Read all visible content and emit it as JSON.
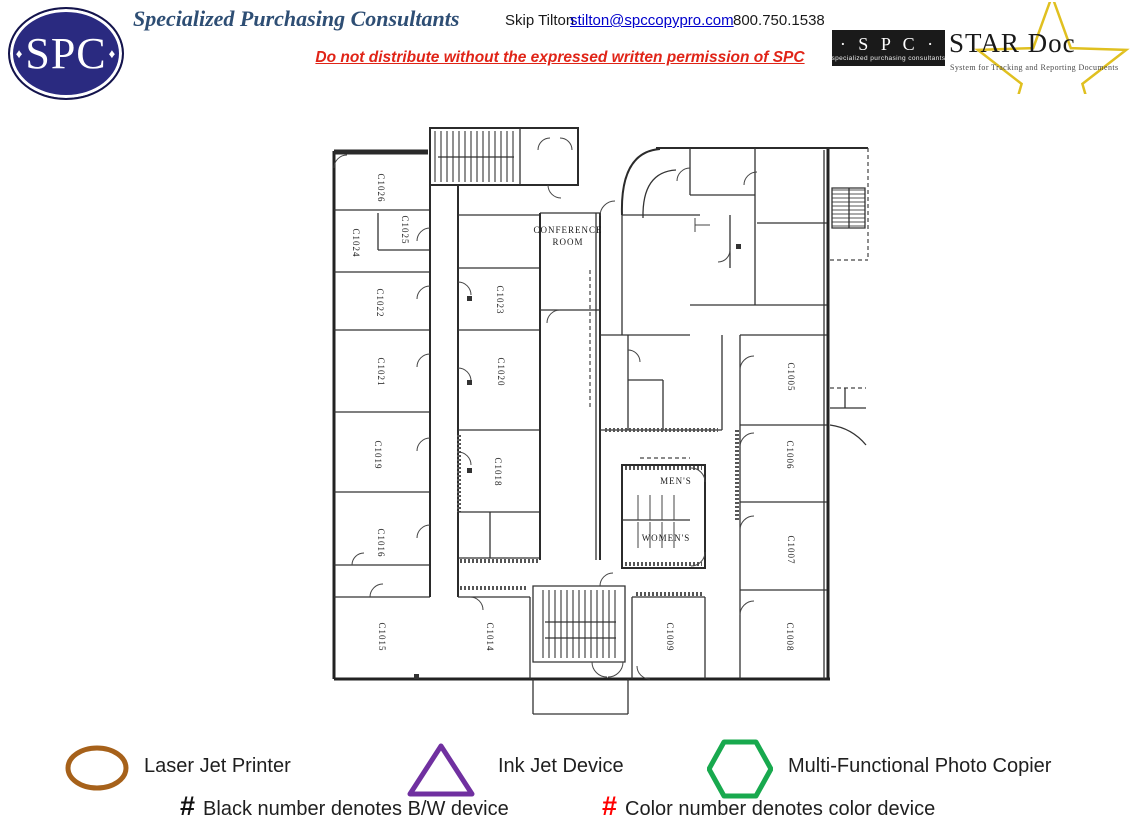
{
  "header": {
    "logo_text": "SPC",
    "title": "Specialized Purchasing Consultants",
    "contact_name": "Skip Tilton",
    "contact_email": "stilton@spccopypro.com",
    "contact_phone": "800.750.1538",
    "notice": "Do not distribute without the expressed written permission of SPC",
    "stardoc": {
      "spc": "· S P C ·",
      "spc_sub": "specialized purchasing consultants",
      "name": "STAR Doc",
      "tagline": "System for Tracking and Reporting Documents",
      "star_color": "#e0c020"
    }
  },
  "icons": {
    "diamond": "♦"
  },
  "floorplan": {
    "room_labels": [
      {
        "lines": [
          "C1026"
        ],
        "x": 378,
        "y": 188,
        "r": 90
      },
      {
        "lines": [
          "C1025"
        ],
        "x": 402,
        "y": 230,
        "r": 90
      },
      {
        "lines": [
          "C1024"
        ],
        "x": 353,
        "y": 243,
        "r": 90
      },
      {
        "lines": [
          "C1022"
        ],
        "x": 377,
        "y": 303,
        "r": 90
      },
      {
        "lines": [
          "C1021"
        ],
        "x": 378,
        "y": 372,
        "r": 90
      },
      {
        "lines": [
          "C1019"
        ],
        "x": 375,
        "y": 455,
        "r": 90
      },
      {
        "lines": [
          "C1016"
        ],
        "x": 378,
        "y": 543,
        "r": 90
      },
      {
        "lines": [
          "C1015"
        ],
        "x": 379,
        "y": 637,
        "r": 90
      },
      {
        "lines": [
          "C1023"
        ],
        "x": 497,
        "y": 300,
        "r": 90
      },
      {
        "lines": [
          "C1020"
        ],
        "x": 498,
        "y": 372,
        "r": 90
      },
      {
        "lines": [
          "C1018"
        ],
        "x": 495,
        "y": 472,
        "r": 90
      },
      {
        "lines": [
          "C1014"
        ],
        "x": 487,
        "y": 637,
        "r": 90
      },
      {
        "lines": [
          "C1005"
        ],
        "x": 788,
        "y": 377,
        "r": 90
      },
      {
        "lines": [
          "C1006"
        ],
        "x": 787,
        "y": 455,
        "r": 90
      },
      {
        "lines": [
          "C1007"
        ],
        "x": 788,
        "y": 550,
        "r": 90
      },
      {
        "lines": [
          "C1008"
        ],
        "x": 787,
        "y": 637,
        "r": 90
      },
      {
        "lines": [
          "C1009"
        ],
        "x": 667,
        "y": 637,
        "r": 90
      },
      {
        "lines": [
          "CONFERENCE",
          "ROOM"
        ],
        "x": 568,
        "y": 233,
        "r": 0
      },
      {
        "lines": [
          "MEN'S"
        ],
        "x": 676,
        "y": 484,
        "r": 0
      },
      {
        "lines": [
          "WOMEN'S"
        ],
        "x": 666,
        "y": 541,
        "r": 0
      }
    ]
  },
  "legend": {
    "items": [
      {
        "shape": "oval",
        "label": "Laser Jet Printer",
        "color": "#A6611A"
      },
      {
        "shape": "triangle",
        "label": "Ink Jet Device",
        "color": "#7030A0"
      },
      {
        "shape": "hexagon",
        "label": "Multi-Functional Photo Copier",
        "color": "#18A94E"
      }
    ],
    "notes": [
      {
        "symbol": "#",
        "symbol_color": "#111111",
        "text": "Black number denotes B/W device"
      },
      {
        "symbol": "#",
        "symbol_color": "#FF0000",
        "text": "Color number denotes color device"
      }
    ]
  }
}
